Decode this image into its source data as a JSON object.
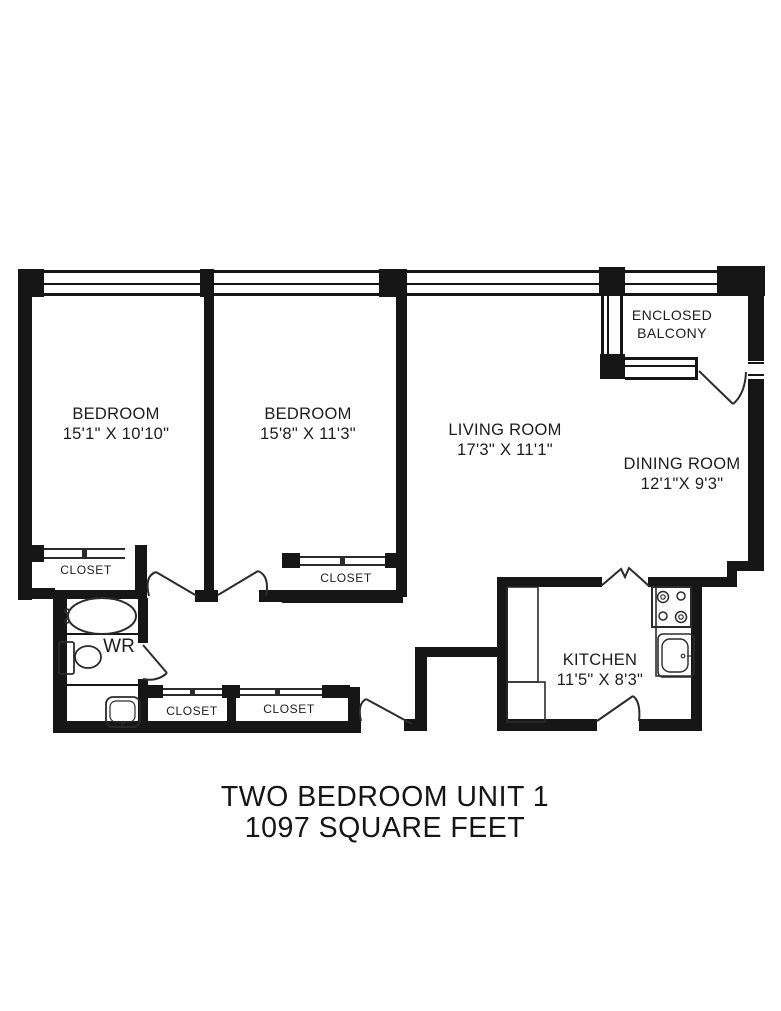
{
  "colors": {
    "wall": "#161616",
    "line": "#2b2b2b",
    "background": "#ffffff",
    "text": "#1c1c1c"
  },
  "title": {
    "line1": "TWO BEDROOM UNIT 1",
    "line2": "1097 SQUARE FEET"
  },
  "rooms": {
    "bedroom1": {
      "label": "BEDROOM",
      "dims": "15'1\" X 10'10\""
    },
    "bedroom2": {
      "label": "BEDROOM",
      "dims": "15'8\" X 11'3\""
    },
    "living_room": {
      "label": "LIVING ROOM",
      "dims": "17'3\" X 11'1\""
    },
    "dining_room": {
      "label": "DINING ROOM",
      "dims": "12'1\"X 9'3\""
    },
    "kitchen": {
      "label": "KITCHEN",
      "dims": "11'5\" X 8'3\""
    },
    "balcony": {
      "label_line1": "ENCLOSED",
      "label_line2": "BALCONY"
    },
    "washroom": {
      "label": "WR"
    }
  },
  "closets": [
    {
      "label": "CLOSET"
    },
    {
      "label": "CLOSET"
    },
    {
      "label": "CLOSET"
    },
    {
      "label": "CLOSET"
    }
  ]
}
